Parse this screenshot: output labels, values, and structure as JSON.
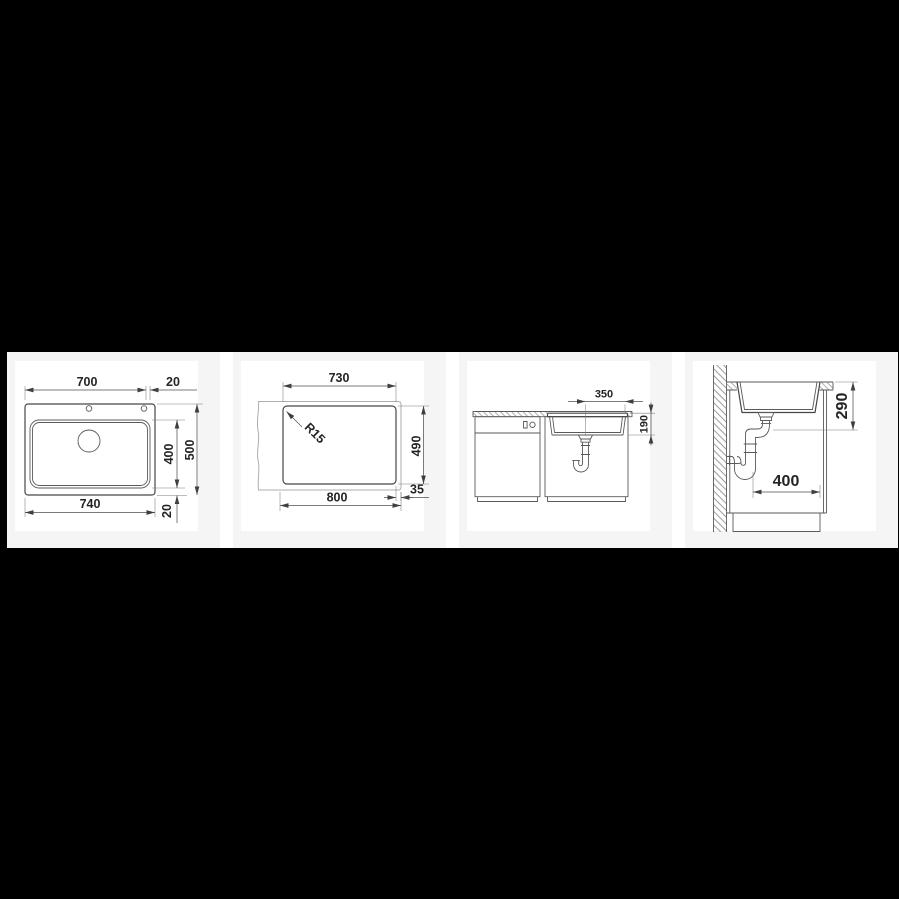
{
  "colors": {
    "page_bg": "#000000",
    "gap_bg": "#ffffff",
    "card_bg": "#f5f5f6",
    "image_bg": "#ffffff",
    "drawing_line": "#474747",
    "light_line": "#adadad",
    "text": "#242424"
  },
  "panels": [
    {
      "name": "sink-top-view",
      "dims": {
        "top_width": "700",
        "top_right_offset": "20",
        "bowl_depth": "400",
        "overall_depth": "500",
        "overall_width": "740",
        "bottom_right_offset": "20"
      }
    },
    {
      "name": "worktop-cutout-plan",
      "dims": {
        "cutout_width": "730",
        "corner_radius": "R15",
        "cutout_depth": "490",
        "cabinet_width": "800",
        "edge_offset": "35"
      }
    },
    {
      "name": "front-section-view",
      "dims": {
        "drain_offset": "350",
        "bowl_depth": "190"
      }
    },
    {
      "name": "side-section-view",
      "dims": {
        "drain_height": "290",
        "trap_clearance": "400"
      }
    }
  ]
}
